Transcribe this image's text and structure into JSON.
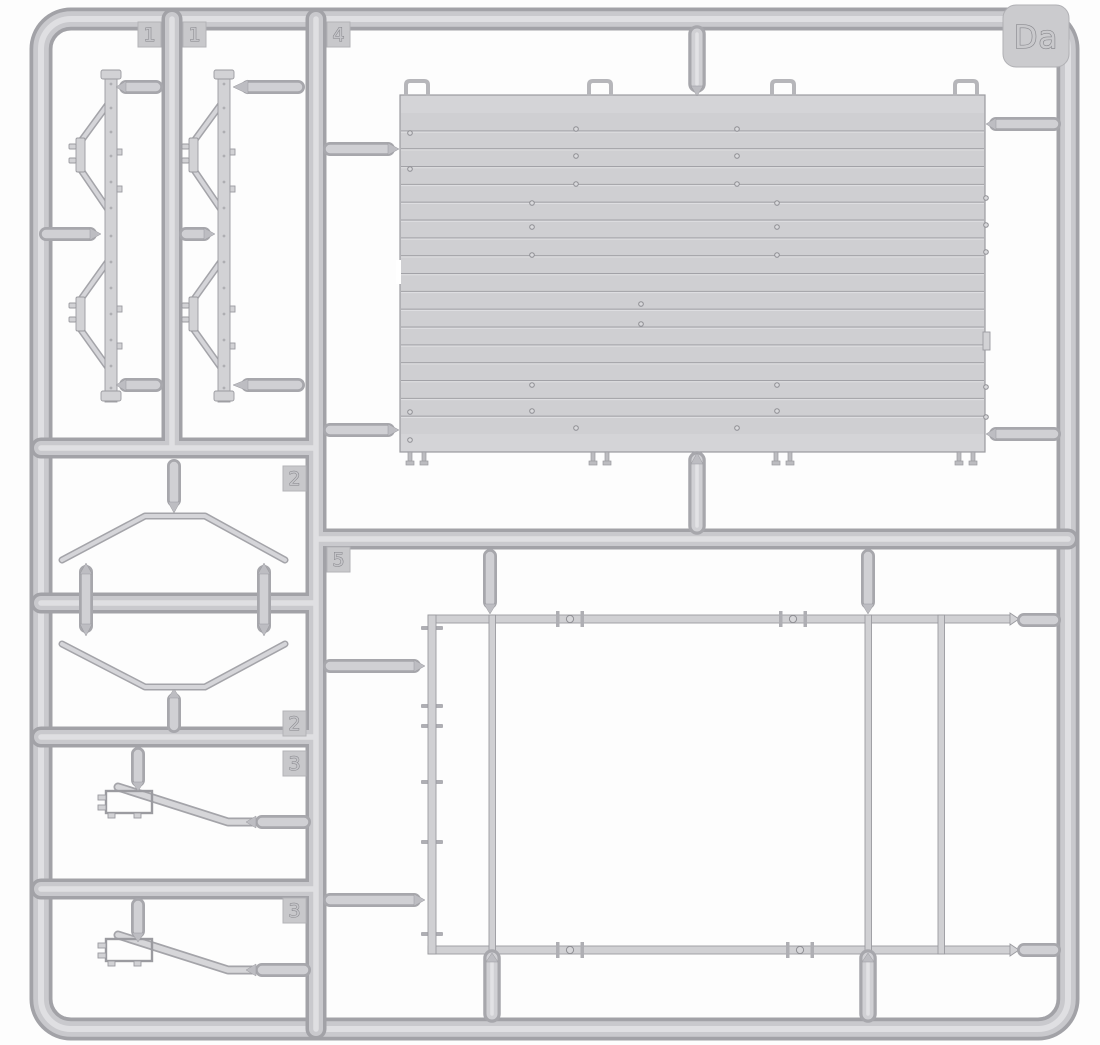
{
  "sprue": {
    "id": "Da",
    "badges": [
      {
        "label": "1"
      },
      {
        "label": "1"
      },
      {
        "label": "4"
      },
      {
        "label": "2"
      },
      {
        "label": "2"
      },
      {
        "label": "3"
      },
      {
        "label": "3"
      },
      {
        "label": "5"
      }
    ]
  },
  "colors": {
    "background": "#ffffff",
    "plastic_highlight": "#dfdfe2",
    "plastic_light": "#d2d2d5",
    "plastic_mid": "#c9c9cd",
    "plastic_shadow": "#a2a2a7",
    "outline": "#8f8f94"
  }
}
